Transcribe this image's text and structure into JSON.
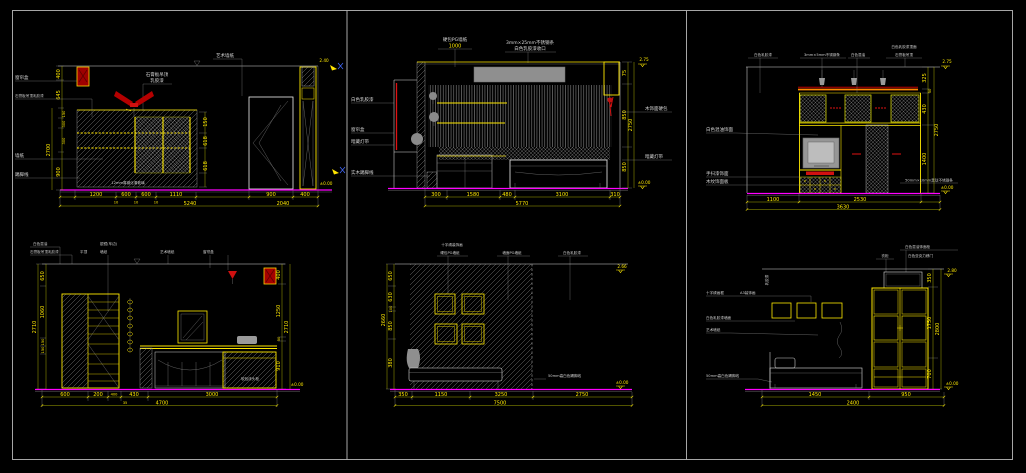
{
  "canvas": {
    "background": "#000000",
    "frame_color": "#b9b9b9",
    "floor_color": "#ff00ff",
    "dim_color": "#ffe900",
    "accent_red": "#e01212",
    "accent_orange": "#ff8a00"
  },
  "panels": {
    "p1": {
      "tr": "艺术墙纸",
      "top1": "石膏板吊顶",
      "top2": "乳胶漆",
      "note": "12mm厚钢化清玻璃",
      "cl": [
        "窗帘盒",
        "石膏板吊顶乳胶漆",
        "墙纸",
        "踢脚线"
      ],
      "vd": [
        "400",
        "645",
        "150",
        "300",
        "300",
        "900"
      ],
      "vo": "2700",
      "rd": [
        "150",
        "618",
        "618"
      ],
      "lv": [
        "2.40",
        "±0.00"
      ],
      "b1": [
        "1200",
        "600",
        "600",
        "1110",
        "900",
        "400"
      ],
      "bs": [
        "10",
        "10",
        "10"
      ],
      "b2": [
        "5240",
        "2040"
      ]
    },
    "p2": {
      "lf": [
        "白色乳胶漆",
        "窗帘盒",
        "暗藏灯带",
        "实木踢脚线"
      ],
      "t1a": "硬包PG墙纸",
      "t1b": "1000",
      "t2a": "3mm×25mm不锈钢条",
      "t2b": "白色乳胶漆收口",
      "rt": [
        "木饰面硬包",
        "暗藏灯带"
      ],
      "rd": [
        "75",
        "850",
        "850"
      ],
      "ro": "2750",
      "lv": [
        "2.75",
        "±0.00"
      ],
      "b1": [
        "300",
        "1580",
        "480",
        "3100",
        "310"
      ],
      "b2": "5770"
    },
    "p3": {
      "tp": [
        "白色乳胶漆",
        "3mm×5mm不锈钢条",
        "白色混油",
        "白色乳胶漆顶面",
        "石膏板吊顶"
      ],
      "lm": "白色混油饰面",
      "bl": [
        "手扫漆饰面",
        "木纹饰面板"
      ],
      "rn": "50mm×10mm黑钛不锈钢条",
      "rd": [
        "325",
        "50",
        "430",
        "1400"
      ],
      "ro": "2750",
      "lv": [
        "2.75",
        "±0.00"
      ],
      "b1": [
        "1100",
        "2530"
      ],
      "b2": "3630"
    },
    "p4": {
      "tp": [
        "白色混油",
        "银镜(车边)",
        "石膏板吊顶乳胶漆",
        "平顶",
        "墙纸",
        "艺术墙纸",
        "窗帘盒"
      ],
      "cab": "软包床头柜",
      "vd": [
        "650",
        "1060",
        "150",
        "150"
      ],
      "vo": "2710",
      "rd": [
        "400",
        "1250",
        "50",
        "910"
      ],
      "ro": "2710",
      "lv": "±0.00",
      "b1": [
        "600",
        "200",
        "400",
        "430",
        "3000"
      ],
      "b2": [
        "35",
        "4700"
      ]
    },
    "p5": {
      "tp": [
        "十字绣装饰画",
        "硬包PG墙纸",
        "墙面PG墙纸",
        "白色乳胶漆"
      ],
      "sk": "50mm高白色踢脚线",
      "vd": [
        "650",
        "630",
        "100",
        "850",
        "380"
      ],
      "vo": "2660",
      "lv": [
        "2.66",
        "±0.00"
      ],
      "b1": [
        "350",
        "1150",
        "3250",
        "2750"
      ],
      "b2": "7500"
    },
    "p6": {
      "tp": [
        "衣柜",
        "白色混油饰面柜",
        "白色亚克力移门"
      ],
      "lf": [
        "十字绣画框",
        "A3装饰画",
        "白色乳胶漆墙面",
        "艺术墙纸",
        "50mm高白色踢脚线"
      ],
      "sd": "乳胶漆",
      "rd": [
        "350",
        "1750",
        "700"
      ],
      "ro": "2800",
      "lv": [
        "2.80",
        "±0.00"
      ],
      "b1": [
        "1450",
        "950"
      ],
      "b2": "2400"
    }
  }
}
